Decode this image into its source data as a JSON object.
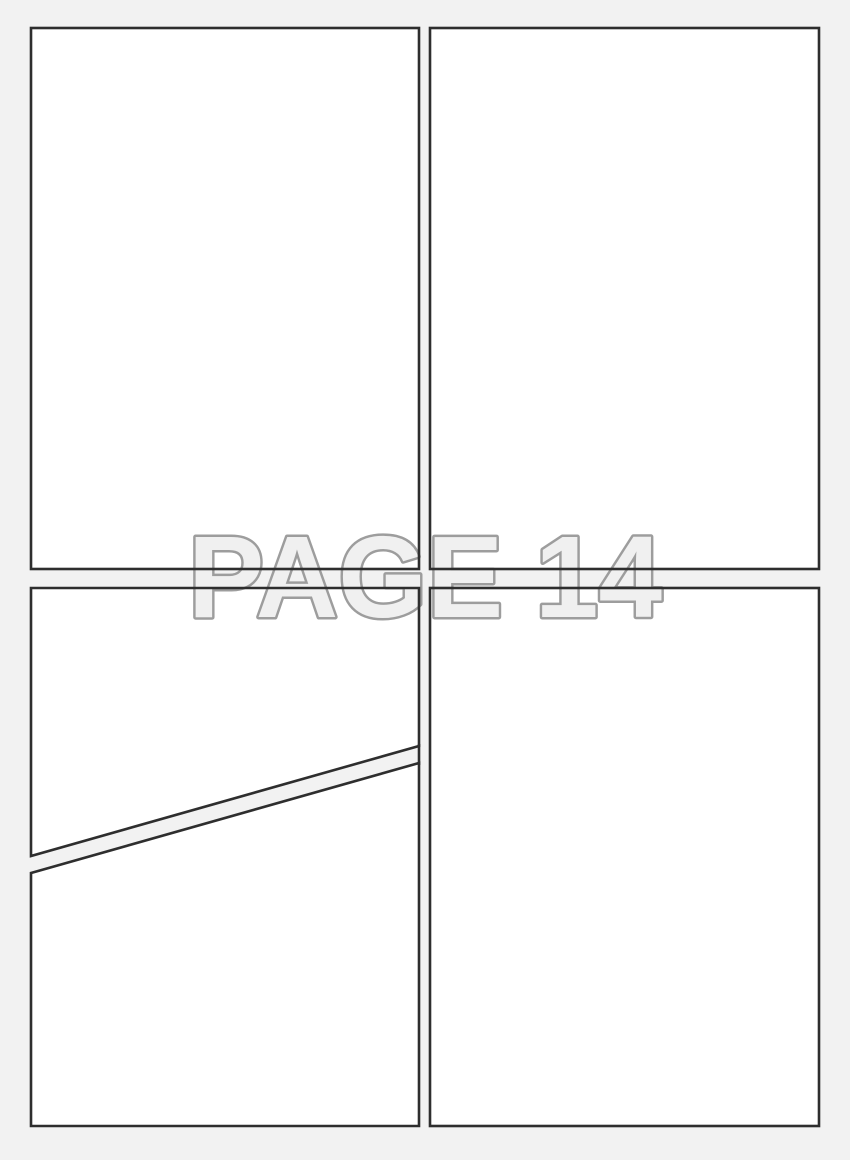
{
  "watermark": {
    "text": "PAGE 14"
  },
  "colors": {
    "page_background": "#f2f2f2",
    "panel_fill": "#ffffff",
    "panel_border": "#2e2e2e",
    "watermark_fill": "#f0f0f0",
    "watermark_outline": "#9d9d9d"
  }
}
